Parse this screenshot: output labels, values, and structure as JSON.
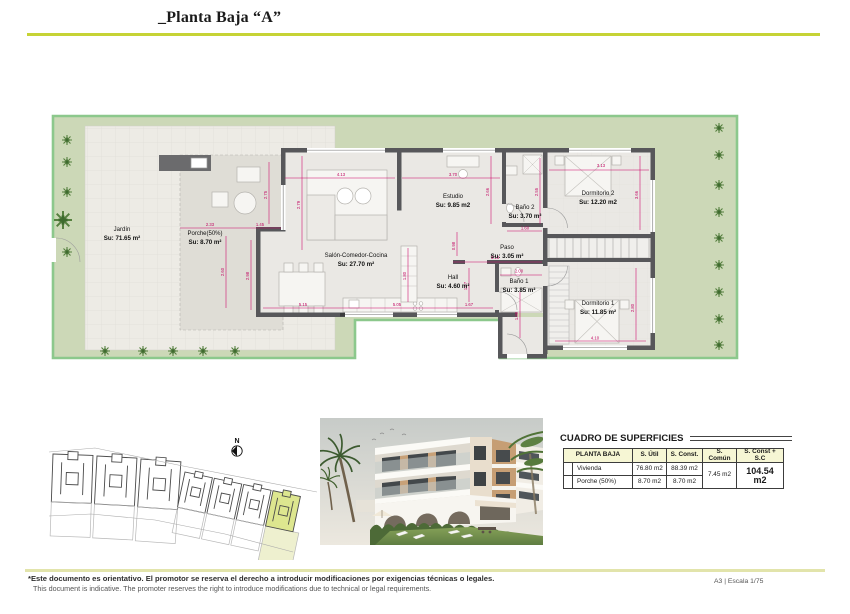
{
  "header": {
    "title": "_Planta Baja “A”"
  },
  "floorplan": {
    "rooms": {
      "jardin": {
        "name": "Jardín",
        "area": "Su: 71.65 m²"
      },
      "porche": {
        "name": "Porche(50%)",
        "area": "Su: 8.70 m²"
      },
      "salon": {
        "name": "Salón-Comedor-Cocina",
        "area": "Su: 27.70 m²"
      },
      "estudio": {
        "name": "Estudio",
        "area": "Su: 9.85 m2"
      },
      "bano2": {
        "name": "Baño 2",
        "area": "Su: 3.70 m²"
      },
      "dorm2": {
        "name": "Dormitorio 2",
        "area": "Su: 12.20 m2"
      },
      "paso": {
        "name": "Paso",
        "area": "Su: 3.05 m²"
      },
      "hall": {
        "name": "Hall",
        "area": "Su: 4.60 m²"
      },
      "bano1": {
        "name": "Baño 1",
        "area": "Su: 3.85 m²"
      },
      "dorm1": {
        "name": "Dormitorio 1",
        "area": "Su: 11.85 m²"
      }
    },
    "dims": {
      "t_salon": "4.13",
      "t_estudio": "3.70",
      "t_dorm2": "3.13",
      "v_salon_left": "2.79",
      "v_porche": "2.75",
      "v_estudio_r": "2.66",
      "v_dorm2_r": "3.66",
      "v_bano2": "2.55",
      "h_bano2": "1.60",
      "h_porche_a": "2.33",
      "h_porche_b": "1.45",
      "v_porche_low": "2.60",
      "v_salon_low": "2.98",
      "b_salon_a": "5.15",
      "b_salon_b": "5.05",
      "v_island": "1.80",
      "v_hall": "1.67",
      "h_hall": "1.67",
      "v_paso": "0.98",
      "h_paso": "3.13",
      "h_bano1": "2.00",
      "v_bano1": "1.88",
      "v_dorm1": "2.80",
      "b_dorm1": "4.10"
    }
  },
  "keyplan": {
    "north": "N"
  },
  "surfaces_table": {
    "title": "CUADRO DE SUPERFICIES",
    "headers": {
      "zone": "PLANTA BAJA",
      "util": "S. Útil",
      "konst": "S. Const.",
      "comun": "S. Común",
      "total": "S. Const + S.C"
    },
    "rows": [
      {
        "label": "Vivienda",
        "util": "76.80 m2",
        "konst": "88.39 m2"
      },
      {
        "label": "Porche (50%)",
        "util": "8.70 m2",
        "konst": "8.70 m2"
      }
    ],
    "comun_value": "7.45 m2",
    "total_value": "104.54 m2"
  },
  "footer": {
    "disclaimer_es": "*Este documento es orientativo. El promotor se reserva el derecho a introducir modificaciones por exigencias técnicas o legales.",
    "disclaimer_en": "This document is indicative. The promoter reserves the right to introduce modifications due to technical or legal requirements.",
    "scale": "A3 | Escala 1/75"
  },
  "colors": {
    "accent_line": "#c6d335",
    "garden_fill": "#ccd8b7",
    "garden_border": "#8cc88c",
    "wall": "#57575a",
    "dimension": "#c0005f",
    "table_header_bg": "#f6f6d4",
    "keyplan_highlight": "#dde68f"
  }
}
